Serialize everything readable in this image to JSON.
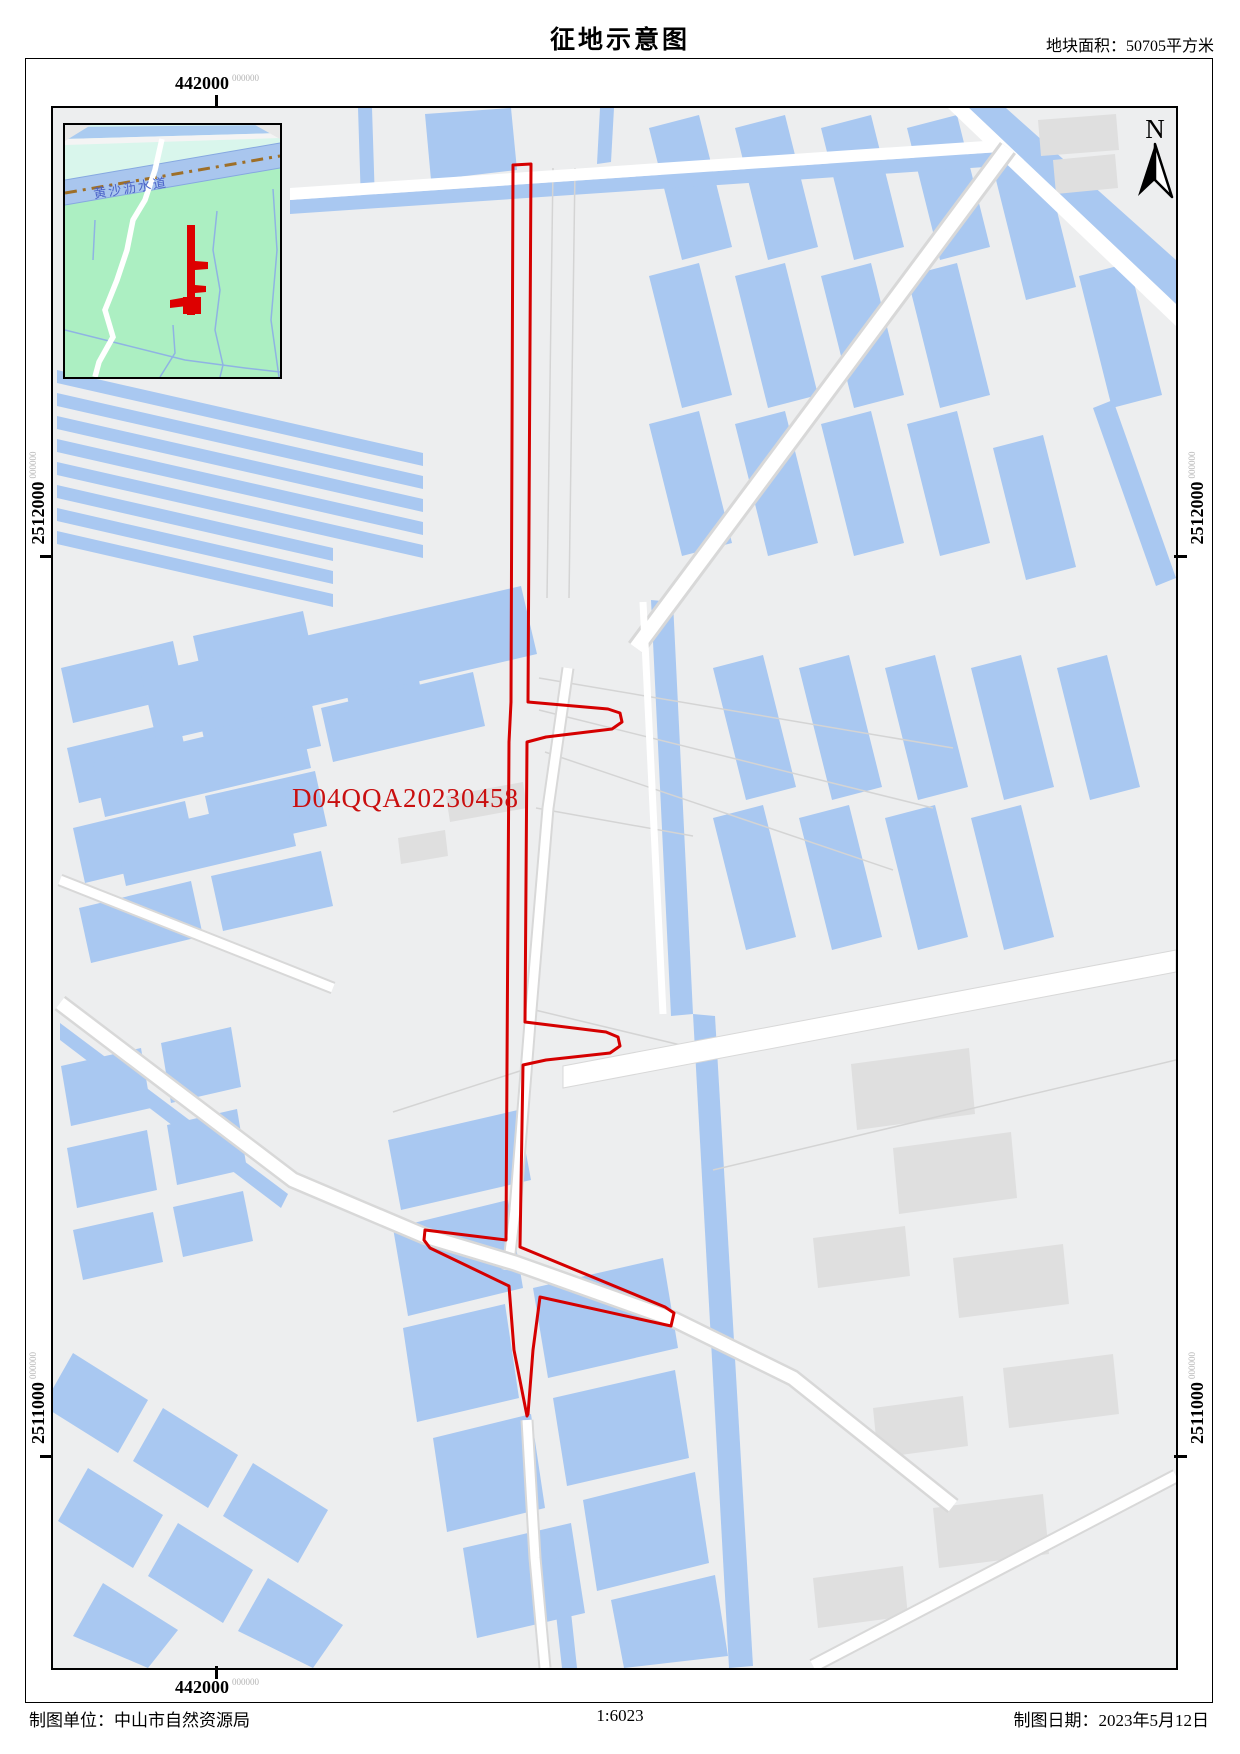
{
  "header": {
    "title": "征地示意图",
    "area_label": "地块面积：50705平方米"
  },
  "grid": {
    "easting": "442000",
    "northing_upper": "2512000",
    "northing_lower": "2511000",
    "decimals": "000000"
  },
  "map": {
    "parcel_id": "D04QQA20230458",
    "north_label": "N",
    "inset": {
      "river_label": "黄沙沥水道"
    }
  },
  "footer": {
    "agency": "制图单位：中山市自然资源局",
    "scale": "1:6023",
    "date": "制图日期：2023年5月12日"
  },
  "colors": {
    "water": "#A9C8F1",
    "land": "#EDEEEF",
    "building": "#DFDFDF",
    "parcel_outline": "#D50000",
    "parcel_label": "#C90F0F",
    "inset_land": "#ACEFC2",
    "inset_upper_zone": "#D9F6EC",
    "inset_river": "#A9C6EE",
    "boundary_line": "#9E6F28",
    "river_label_blue": "#4A62C8"
  }
}
